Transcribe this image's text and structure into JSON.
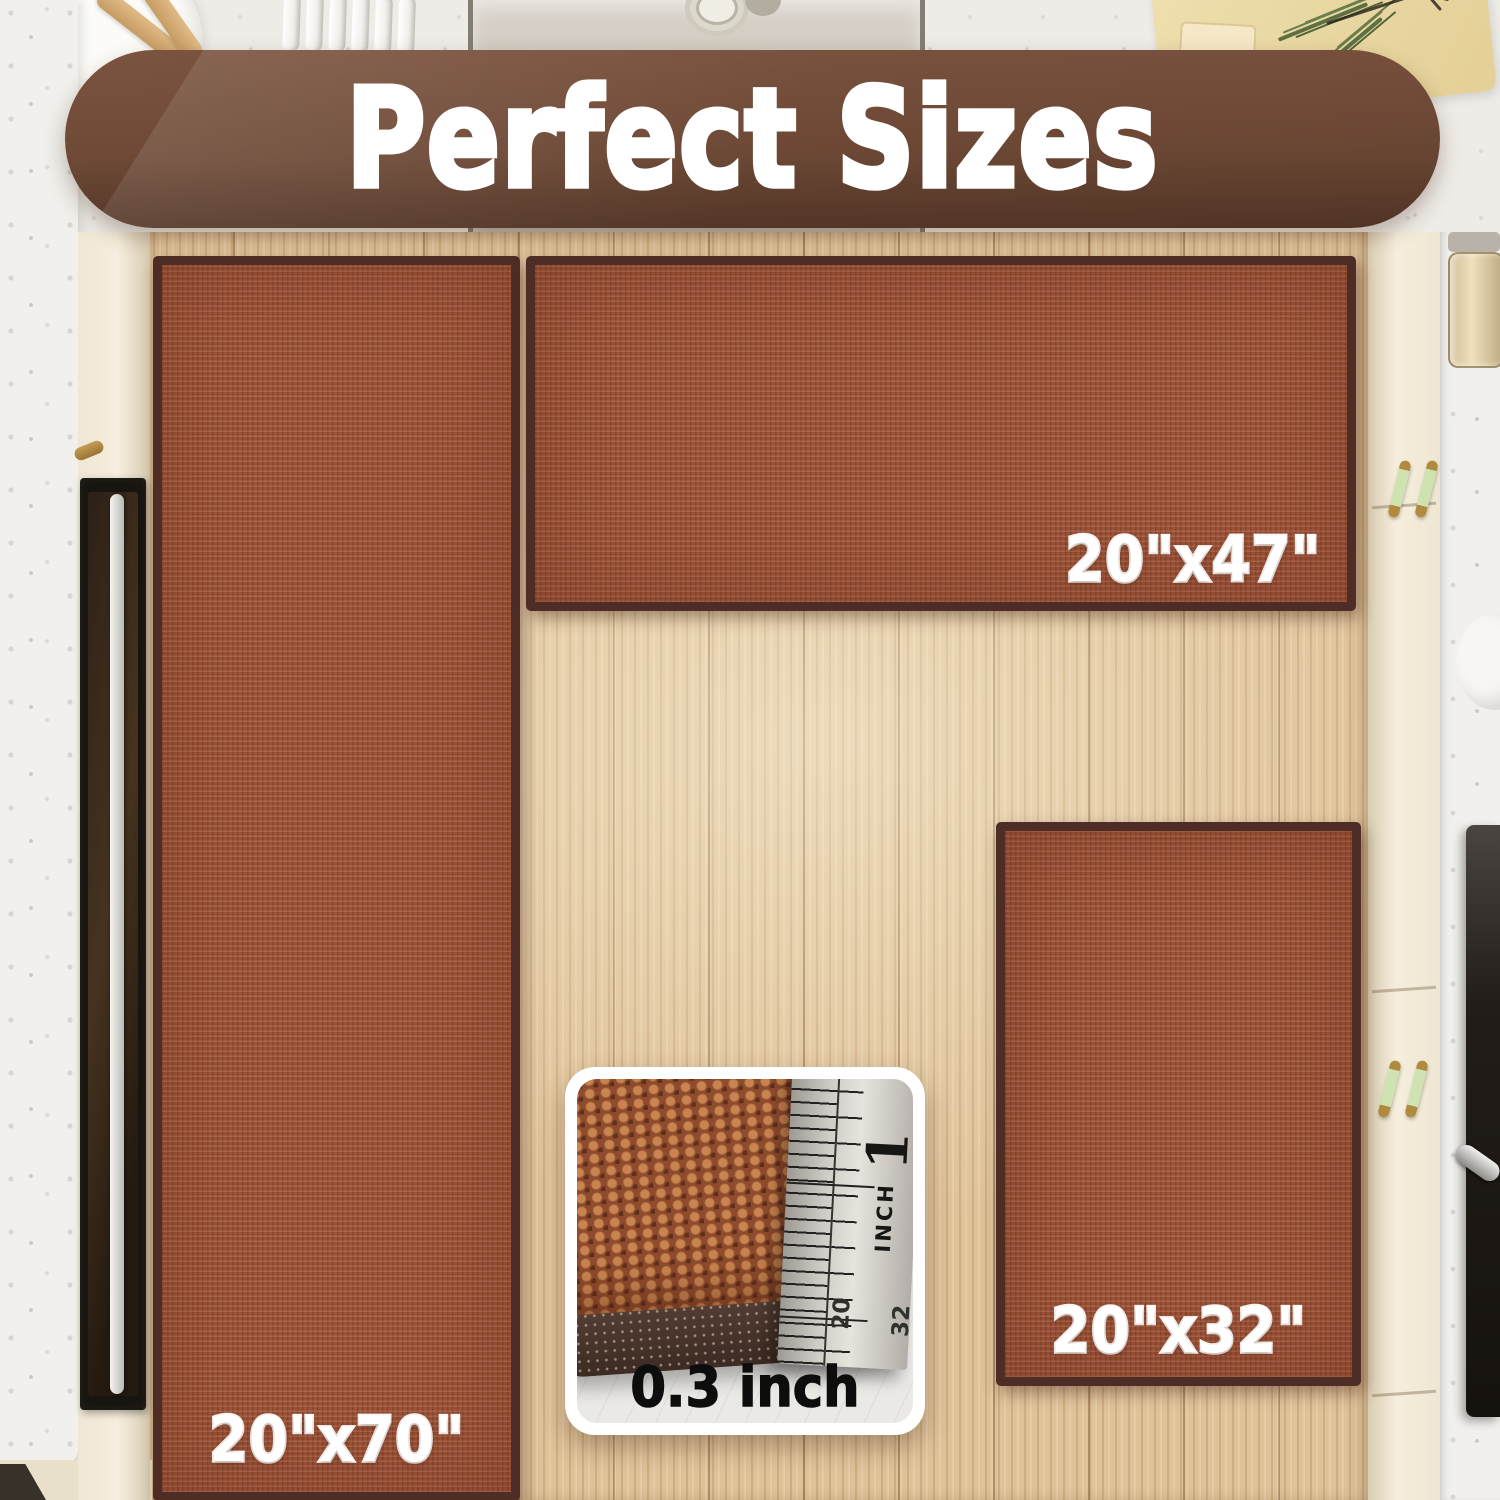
{
  "banner": {
    "title": "Perfect Sizes"
  },
  "rugs": [
    {
      "name": "runner",
      "size_label": "20\"x70\""
    },
    {
      "name": "wide",
      "size_label": "20\"x47\""
    },
    {
      "name": "small",
      "size_label": "20\"x32\""
    }
  ],
  "inset": {
    "thickness_label": "0.3 inch",
    "ruler": {
      "unit": "INCH",
      "one": "1",
      "n20": "20",
      "n32": "32"
    }
  },
  "colors": {
    "banner-brown": "#6f4a37",
    "rug-rust": "#9c5237",
    "rug-border": "#4e2d27",
    "wood-floor": "#dfc298",
    "label-white": "#ffffff",
    "thickness-text": "#0d0d0d"
  }
}
